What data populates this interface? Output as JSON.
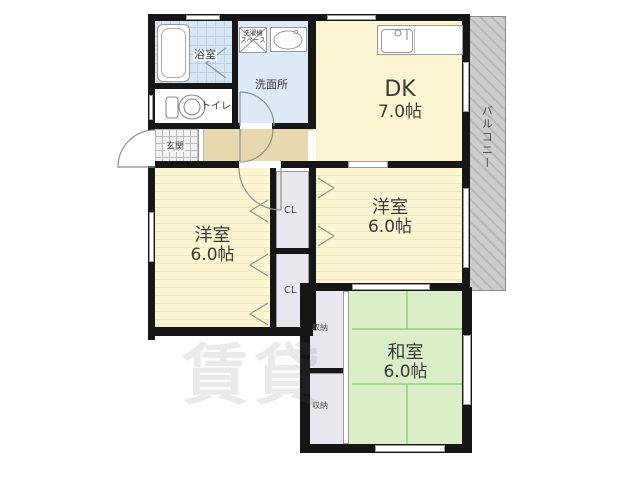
{
  "floorplan": {
    "watermark": "賃貸",
    "rooms": {
      "dk": {
        "name": "DK",
        "size": "7.0帖"
      },
      "western1": {
        "name": "洋室",
        "size": "6.0帖"
      },
      "western2": {
        "name": "洋室",
        "size": "6.0帖"
      },
      "japanese": {
        "name": "和室",
        "size": "6.0帖"
      },
      "bathroom": {
        "name": "浴室"
      },
      "washroom": {
        "name": "洗面所"
      },
      "toilet": {
        "name": "トイレ"
      },
      "entrance": {
        "name": "玄関"
      },
      "balcony": {
        "name": "バルコニー"
      },
      "washer_space": {
        "line1": "洗濯機",
        "line2": "スペース"
      },
      "closet_top": {
        "name": "CL"
      },
      "closet_bottom": {
        "name": "CL"
      },
      "storage_top": {
        "name": "収納"
      },
      "storage_bottom": {
        "name": "収納"
      }
    },
    "colors": {
      "wall": "#161616",
      "room_yellow": "#FBF6D1",
      "water_blue": "#DCE9F6",
      "hall_tan": "#E7D8AF",
      "closet_gray": "#E9E6EE",
      "tatami_green": "#DAEFC7",
      "balcony_gray": "#CDCDCD"
    }
  }
}
